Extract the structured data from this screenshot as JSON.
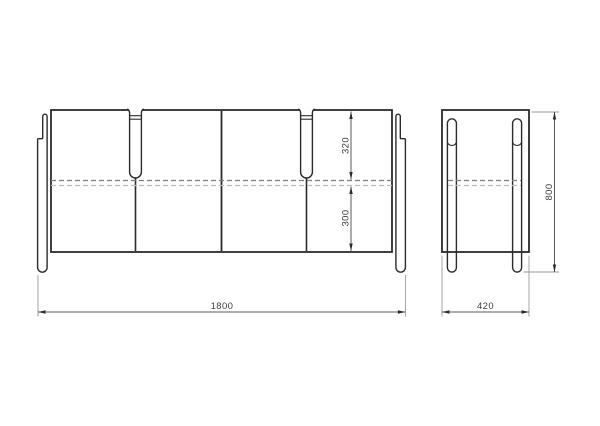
{
  "drawing": {
    "type": "furniture-technical-drawing",
    "views": [
      "front",
      "side"
    ],
    "front_view": {
      "width_label": "1800",
      "top_section_label": "320",
      "bottom_section_label": "300"
    },
    "side_view": {
      "depth_label": "420",
      "height_label": "800"
    }
  },
  "colors": {
    "background": "#ffffff",
    "outline": "#2b2b2b",
    "slot_fill": "#ffffff",
    "dashed_upper": "#7d7d7d",
    "dashed_lower": "#bdbdbd",
    "dimension_line": "#5a5a5a",
    "extension_line": "#9a9a9a",
    "arrow": "#2b2b2b",
    "text": "#3c3c3c"
  }
}
